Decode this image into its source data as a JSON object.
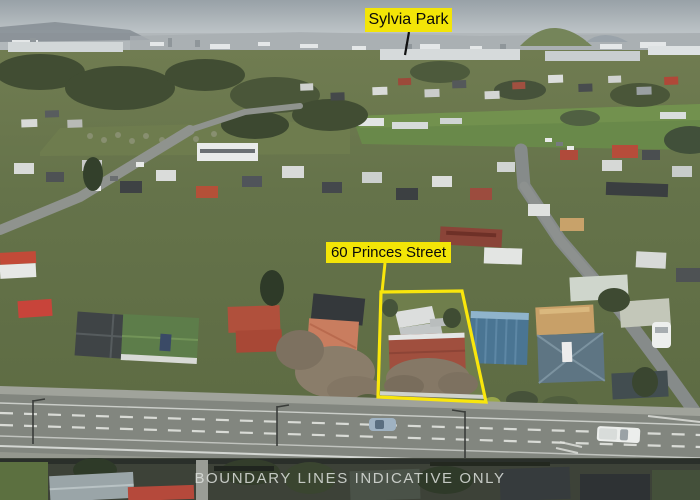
{
  "annotations": {
    "poi_label": "Sylvia Park",
    "address_label": "60 Princes Street",
    "disclaimer": "BOUNDARY LINES INDICATIVE ONLY"
  },
  "colors": {
    "label_bg": "#f3e507",
    "label_text": "#0a0a0a",
    "boundary": "#f9e60c",
    "disclaimer_text": "#dde1dd"
  },
  "scene": {
    "description": "Aerial drone photo of a suburban street block on an overcast day; yellow outline marks the property at 60 Princes Street with Sylvia Park visible on the skyline",
    "sky_color": "#9aa3a9",
    "grass_color": "#637144",
    "road_color": "#82867f",
    "property_roof_color": "#a04f3e"
  }
}
